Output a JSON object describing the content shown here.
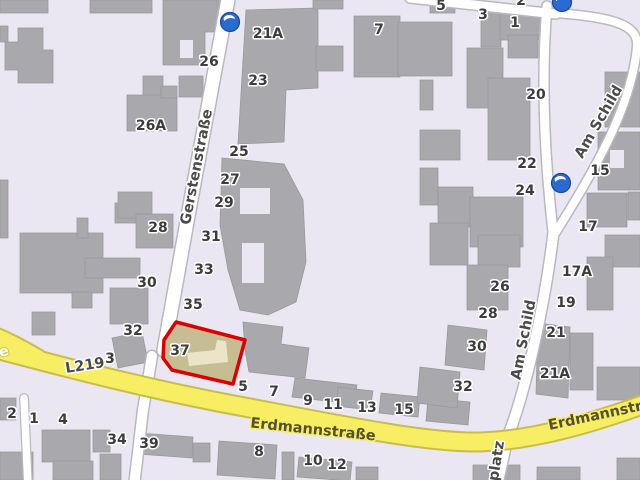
{
  "map": {
    "type": "street-map",
    "highlighted_building_number": "37",
    "palette": {
      "background": "#ebe7f2",
      "building_fill": "#a9a9ad",
      "building_stroke": "#98989d",
      "road_fill": "#ffffff",
      "road_casing": "#b9b9bd",
      "main_road_fill": "#f7ee64",
      "main_road_casing": "#c9bc4f",
      "highlight_outline": "#dd0000",
      "highlight_fill": "#c6bd92",
      "highlight_inner": "#ebe4c6",
      "oneway_blue": "#2a6bd2",
      "label_color": "#3c3c3c"
    },
    "street_labels": [
      {
        "text": "Gerstenstraße",
        "x": 197,
        "y": 167,
        "rot": -79,
        "halo": "white",
        "size": 15
      },
      {
        "text": "Erdmannstraße",
        "x": 313,
        "y": 430,
        "rot": 6,
        "halo": "yellow",
        "size": 15
      },
      {
        "text": "Erdmannstraße",
        "x": 610,
        "y": 413,
        "rot": -12,
        "halo": "yellow",
        "size": 15
      },
      {
        "text": "Am Schild",
        "x": 599,
        "y": 122,
        "rot": -60,
        "halo": "white",
        "size": 15
      },
      {
        "text": "Am Schild",
        "x": 524,
        "y": 340,
        "rot": -79,
        "halo": "white",
        "size": 15
      },
      {
        "text": "platz",
        "x": 497,
        "y": 461,
        "rot": -81,
        "halo": "white",
        "size": 14
      },
      {
        "text": "L219",
        "x": 85,
        "y": 366,
        "rot": -9,
        "halo": "white",
        "size": 13
      },
      {
        "text": "e",
        "x": 4,
        "y": 352,
        "rot": -18,
        "halo": "white-on-yellow",
        "size": 13
      }
    ],
    "house_numbers": [
      {
        "text": "26",
        "x": 209,
        "y": 62
      },
      {
        "text": "26A",
        "x": 151,
        "y": 126
      },
      {
        "text": "28",
        "x": 158,
        "y": 228
      },
      {
        "text": "30",
        "x": 147,
        "y": 283
      },
      {
        "text": "32",
        "x": 133,
        "y": 331
      },
      {
        "text": "3",
        "x": 110,
        "y": 359
      },
      {
        "text": "2",
        "x": 12,
        "y": 414
      },
      {
        "text": "1",
        "x": 34,
        "y": 419
      },
      {
        "text": "4",
        "x": 63,
        "y": 420
      },
      {
        "text": "34",
        "x": 117,
        "y": 440
      },
      {
        "text": "39",
        "x": 149,
        "y": 444
      },
      {
        "text": "21A",
        "x": 268,
        "y": 34
      },
      {
        "text": "23",
        "x": 258,
        "y": 81
      },
      {
        "text": "25",
        "x": 239,
        "y": 152
      },
      {
        "text": "27",
        "x": 230,
        "y": 180
      },
      {
        "text": "29",
        "x": 224,
        "y": 203
      },
      {
        "text": "31",
        "x": 211,
        "y": 237
      },
      {
        "text": "33",
        "x": 204,
        "y": 270
      },
      {
        "text": "35",
        "x": 193,
        "y": 305
      },
      {
        "text": "37",
        "x": 180,
        "y": 351
      },
      {
        "text": "7",
        "x": 379,
        "y": 30
      },
      {
        "text": "5",
        "x": 243,
        "y": 387
      },
      {
        "text": "7",
        "x": 274,
        "y": 392
      },
      {
        "text": "9",
        "x": 308,
        "y": 401
      },
      {
        "text": "11",
        "x": 333,
        "y": 405
      },
      {
        "text": "13",
        "x": 367,
        "y": 408
      },
      {
        "text": "15",
        "x": 404,
        "y": 410
      },
      {
        "text": "8",
        "x": 259,
        "y": 452
      },
      {
        "text": "10",
        "x": 313,
        "y": 461
      },
      {
        "text": "12",
        "x": 337,
        "y": 465
      },
      {
        "text": "5",
        "x": 441,
        "y": 6
      },
      {
        "text": "3",
        "x": 483,
        "y": 15
      },
      {
        "text": "1",
        "x": 515,
        "y": 23
      },
      {
        "text": "2",
        "x": 521,
        "y": 1
      },
      {
        "text": "20",
        "x": 536,
        "y": 95
      },
      {
        "text": "22",
        "x": 527,
        "y": 164
      },
      {
        "text": "24",
        "x": 525,
        "y": 191
      },
      {
        "text": "26",
        "x": 500,
        "y": 287
      },
      {
        "text": "28",
        "x": 488,
        "y": 314
      },
      {
        "text": "30",
        "x": 477,
        "y": 347
      },
      {
        "text": "32",
        "x": 463,
        "y": 387
      },
      {
        "text": "21",
        "x": 556,
        "y": 333
      },
      {
        "text": "21A",
        "x": 555,
        "y": 374
      },
      {
        "text": "15",
        "x": 600,
        "y": 171
      },
      {
        "text": "17",
        "x": 588,
        "y": 227
      },
      {
        "text": "17A",
        "x": 577,
        "y": 272
      },
      {
        "text": "19",
        "x": 566,
        "y": 303
      }
    ],
    "oneway_markers": [
      {
        "x": 230,
        "y": 22
      },
      {
        "x": 561,
        "y": 183
      },
      {
        "x": 562,
        "y": 2
      }
    ]
  }
}
